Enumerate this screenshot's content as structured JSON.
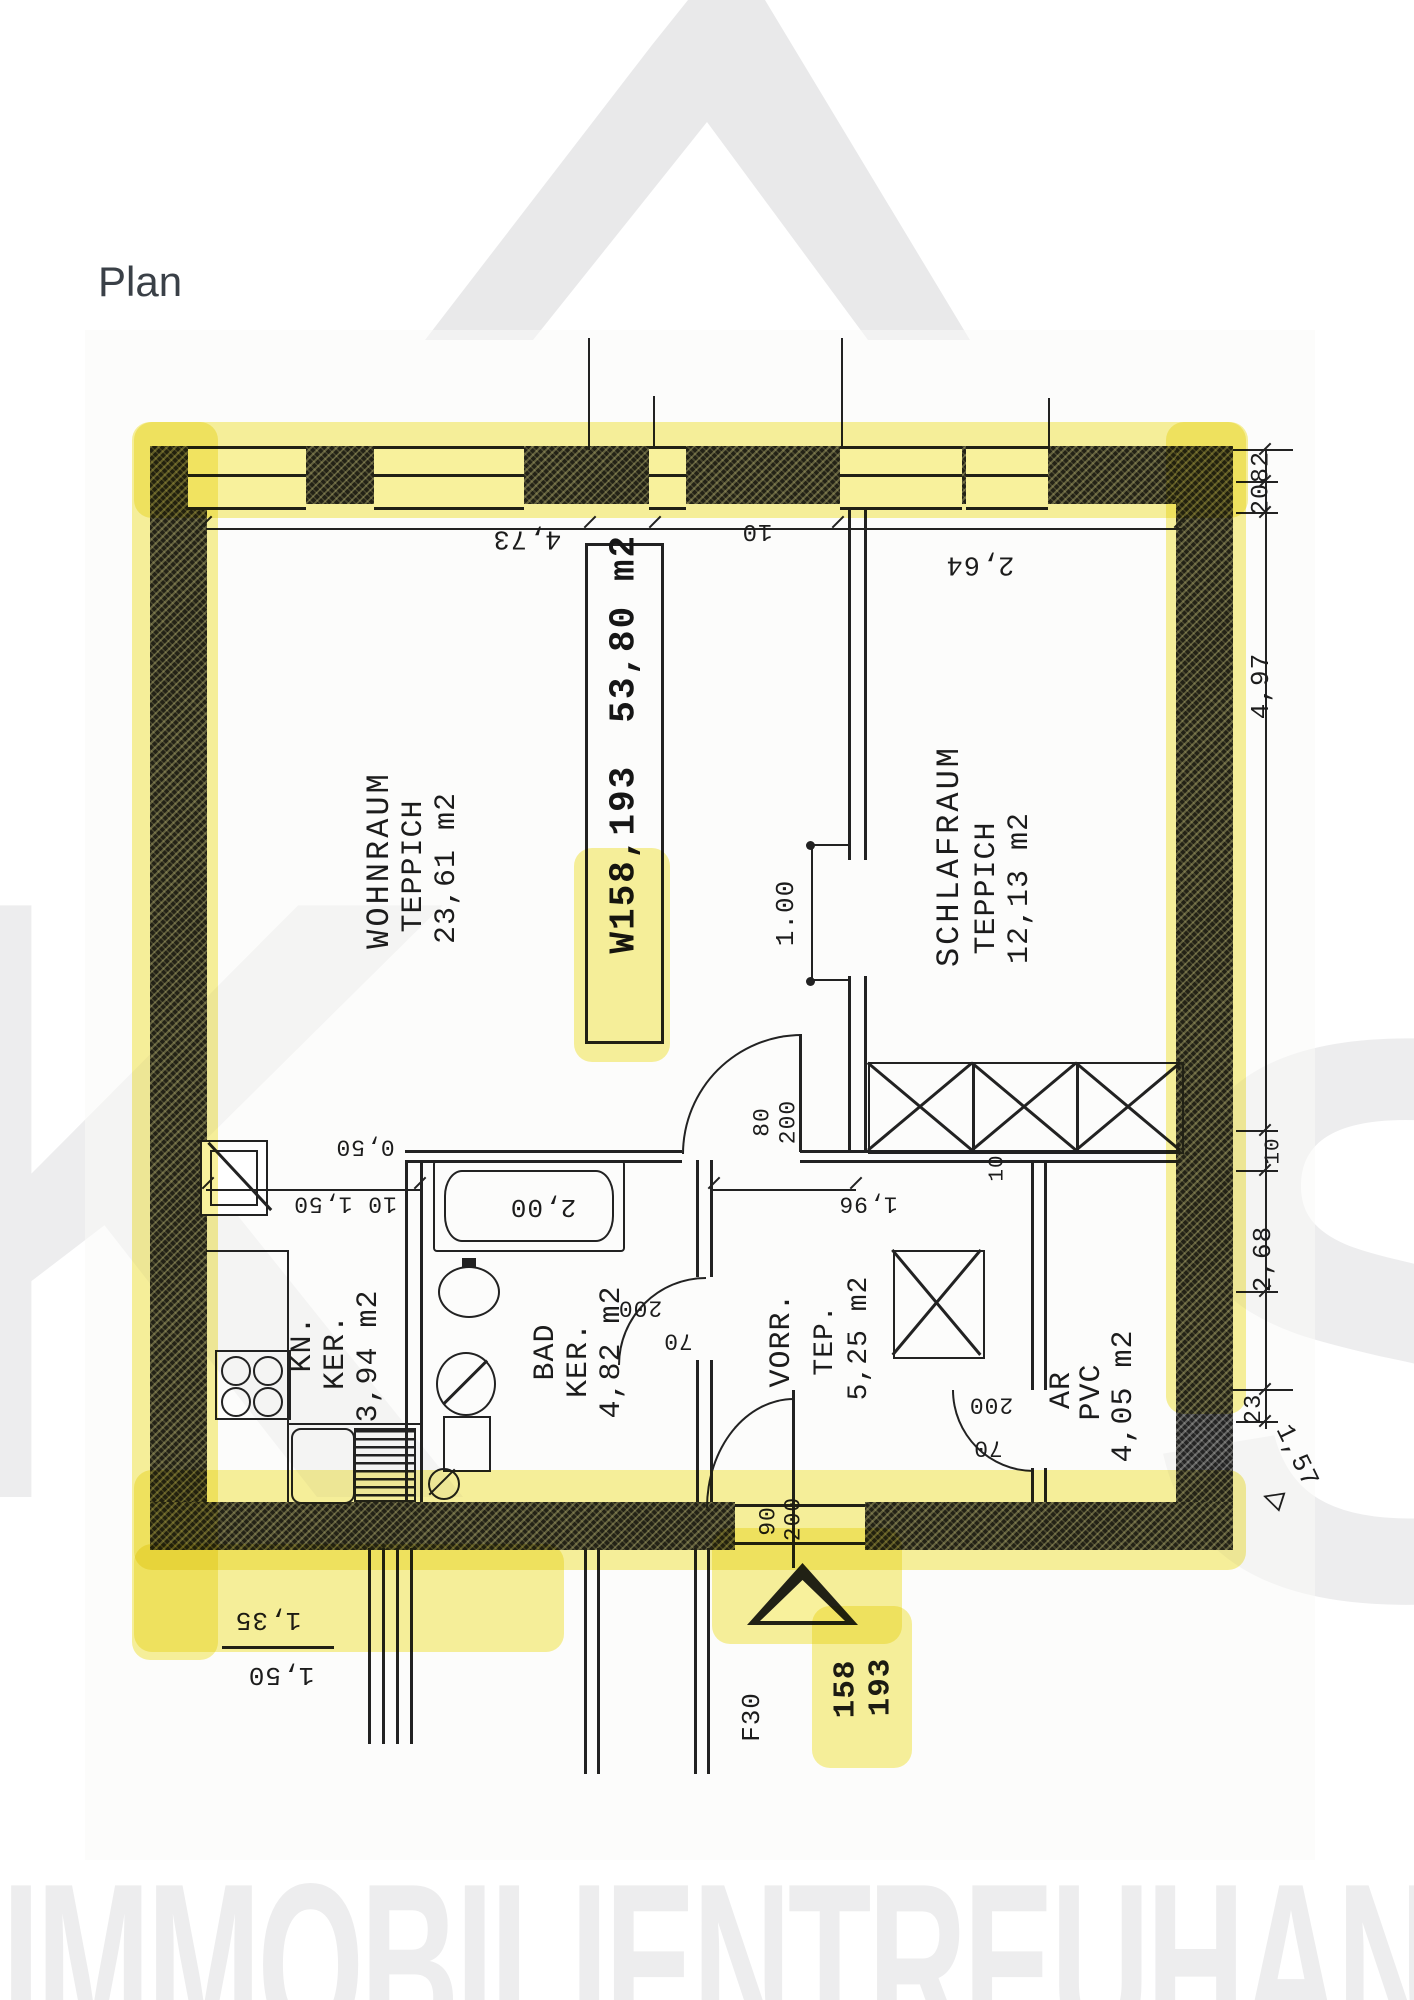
{
  "page": {
    "title": "Plan"
  },
  "watermarks": {
    "left_letter": "K",
    "right_letter": "S",
    "bottom_text": "IMMOBILIENTREUHAND"
  },
  "colors": {
    "highlight": "#f3e54a",
    "ink": "#1c1c1c",
    "watermark_gray": "#ededee"
  },
  "icons": {
    "open_triangle": "◁"
  },
  "plan": {
    "unit_box": {
      "number_highlighted": "W158,",
      "number_rest": "193",
      "area": "53,80 m2"
    },
    "rooms": {
      "wohnraum": {
        "name": "WOHNRAUM",
        "floor": "TEPPICH",
        "area": "23,61 m2"
      },
      "schlafraum": {
        "name": "SCHLAFRAUM",
        "floor": "TEPPICH",
        "area": "12,13 m2"
      },
      "kueche": {
        "name": "KN.",
        "floor": "KER.",
        "area": "3,94 m2"
      },
      "bad": {
        "name": "BAD",
        "floor": "KER.",
        "area": "4,82 m2"
      },
      "vorraum": {
        "name": "VORR.",
        "floor": "TEP.",
        "area": "5,25 m2"
      },
      "abstellraum": {
        "name": "AR",
        "floor": "PVC",
        "area": "4,05 m2"
      }
    },
    "doors": {
      "schlaf_opening": "1.00",
      "wohn_door_w": "80",
      "wohn_door_h": "200",
      "bad_door_h": "200",
      "bad_door_w": "70",
      "entry_door_w": "90",
      "entry_door_h": "200",
      "ar_door_h": "200",
      "ar_door_w": "70"
    },
    "dims": {
      "top_left": "4,73",
      "top_mid": "10",
      "top_right": "2,64",
      "right_a": "82",
      "right_b": "20",
      "right_c": "4,97",
      "right_d": "10",
      "right_e": "2,68",
      "right_f": "23",
      "right_g": "1,57",
      "tub": "2,00",
      "kitchen_opening": "10 1,50",
      "kitchen_small": "0,50",
      "corridor": "1,96",
      "wardrobe_small": "10",
      "terrace_upper": "1,35",
      "terrace_lower": "1,50",
      "fire_rating": "F30",
      "unit_number_1": "158",
      "unit_number_2": "193"
    }
  }
}
